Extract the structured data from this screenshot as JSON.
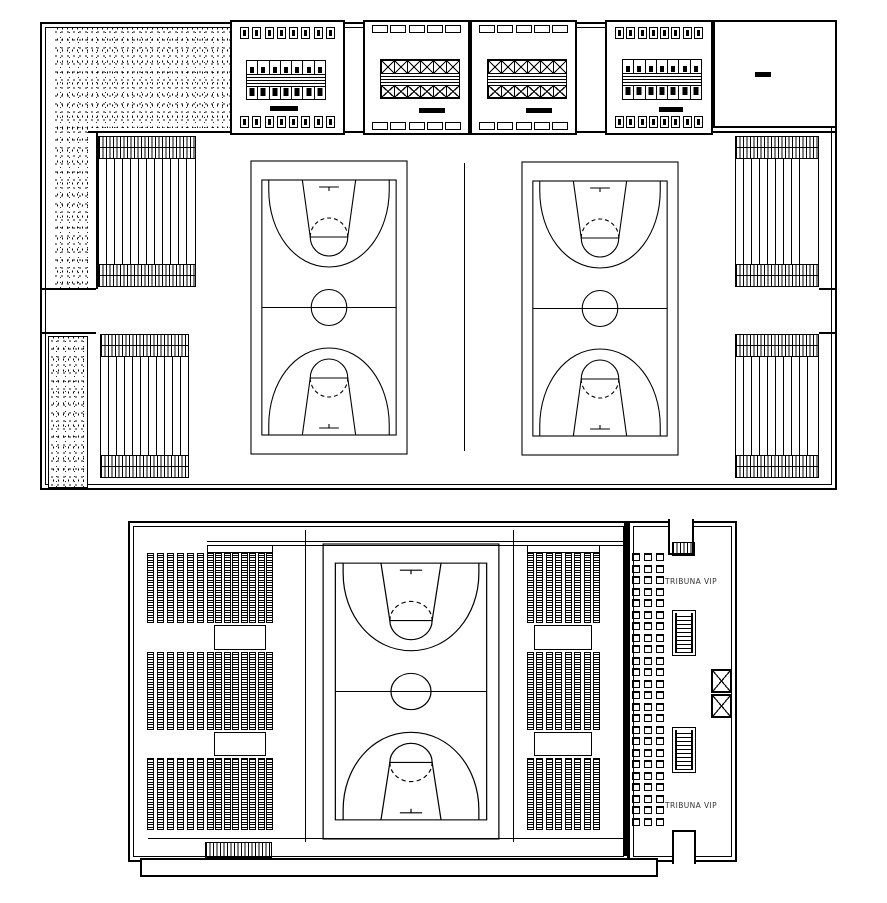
{
  "labels": {
    "tribuna_vip_top": "TRIBUNA VIP",
    "tribuna_vip_bottom": "TRIBUNA VIP"
  },
  "colors": {
    "ink": "#000000",
    "paper": "#ffffff",
    "label_text": "#333333"
  },
  "counts": {
    "locker_small_cells": 8,
    "bench_stalls": 7,
    "x_lockers_per_row": 6,
    "window_cells": 5,
    "seat_cols_outer": 6,
    "seat_cols_inner": 8,
    "seat_cols_right": 8,
    "vip_chair_rows": 24
  }
}
